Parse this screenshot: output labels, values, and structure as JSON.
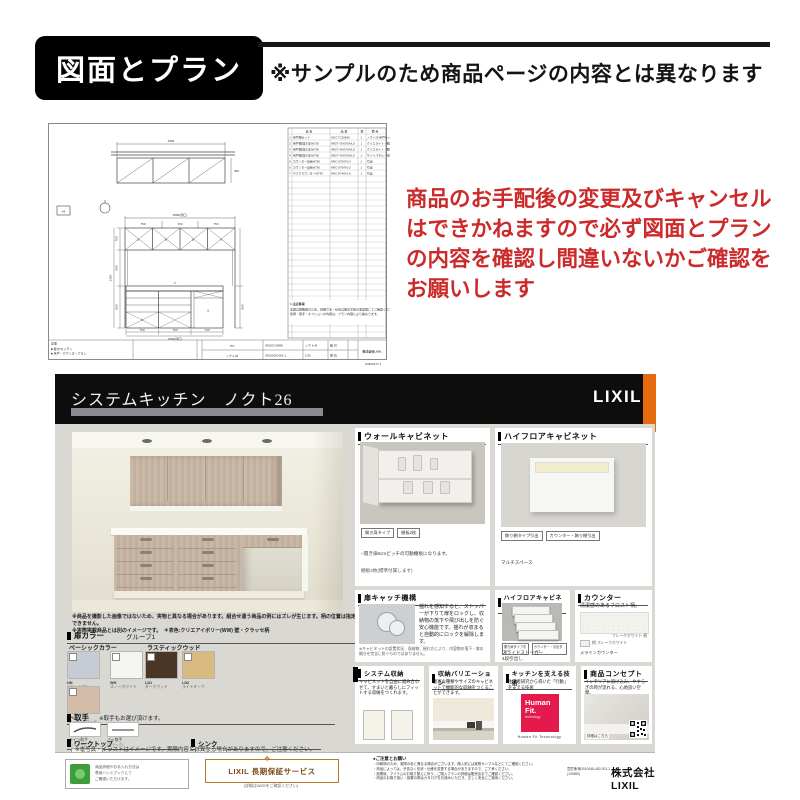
{
  "header": {
    "title": "図面とプラン",
    "note": "※サンプルのため商品ページの内容とは異なります"
  },
  "warning": {
    "text": "商品のお手配後の変更及びキャンセルはできかねますので必ず図面とプランの内容を確認し間違いないかご確認をお願いします",
    "color": "#cc2a2a"
  },
  "drawing": {
    "marker": "A8",
    "plan_total": "2584",
    "plan_height": "350",
    "elev_total": "2584(間口)",
    "elev_parts": [
      "750",
      "700",
      "750"
    ],
    "left_dims": [
      "700",
      "600",
      "850"
    ],
    "left_total": "2350",
    "base_parts": [
      "750",
      "750",
      "740"
    ],
    "base_total": "2584(間口)",
    "refs": {
      "w1": "④",
      "w2": "⑤",
      "w3": "⑥",
      "w4": "⑦",
      "b1": "①",
      "b2": "②",
      "b3": "③"
    },
    "table": {
      "headers": {
        "name": "品  名",
        "code": "品  番",
        "qty": "数",
        "rem": "備  考"
      },
      "rows": [
        [
          "1",
          "吊戸棚セット",
          "NOCT-C2584S",
          "1",
          "ノクト26 吊戸セット(LO)"
        ],
        [
          "2",
          "吊戸棚(開き扉)W750",
          "NR2T-75A075A/LO",
          "1",
          "クリエライト・棚2枚"
        ],
        [
          "3",
          "吊戸棚(開き扉)W700",
          "NR2T-70A070A/LO",
          "1",
          "クリエライト・棚2枚"
        ],
        [
          "4",
          "吊戸棚(開き扉)W750",
          "NR2T-75A075A/LO",
          "1",
          "サイドパネル・化粧"
        ],
        [
          "5",
          "カウンター収納W750",
          "NRC-S75AT/LO",
          "1",
          "引出"
        ],
        [
          "6",
          "カウンター収納W750",
          "NRC-S75AT/LO",
          "1",
          "引出"
        ],
        [
          "7",
          "デスクカウンターW740",
          "NRC-D74AT/LO",
          "1",
          "引出"
        ]
      ],
      "notes_title": "1.注記事項",
      "note1": "本図は概略図のため、詳細寸法・仕様は御注文前の承認図にてご確認ください。",
      "note2": "色柄・取手・オプションの内容は、プラン内容により異なります。"
    },
    "titleblock": {
      "label": "記事",
      "note1": "■ 壁付Iキッチン",
      "note2": "■ 吊戸・カウンタープラン",
      "name": "757",
      "model": "ノクト26",
      "c1a": "4202D 02890",
      "c1b": "4202D3N-001-1",
      "c2a": "ノクト-B",
      "c2b": "1/30",
      "c3a": "縮 尺",
      "c3b": "単 位",
      "company": "株式会社LIXIL",
      "pageno": "A3202477-1"
    }
  },
  "catalog": {
    "title": "システムキッチン　ノクト26",
    "brand": "LIXIL",
    "accent_orange": "#e56a10",
    "disclaimer1": "※商品を撮影した画像ではないため、実物と異なる場合があります。組合せ違う商品の例にはズレが生じます。柄の位置は指定できません。",
    "disclaimer2": "※実際掲載商品とは別のイメージです。　＊表色:クリエアイボリー(WW) 壁・クラッセ柄",
    "door_color": {
      "heading": "扉カラー",
      "group": "グループ1",
      "category_left": "ベーシックカラー",
      "category_right": "ラスティックウッド",
      "swatches": [
        {
          "code": "NN",
          "name": "ソリッドグレー",
          "color": "#c7cbd4"
        },
        {
          "code": "WH",
          "name": "スノーホワイト",
          "color": "#f5f5f2"
        },
        {
          "code": "LD1",
          "name": "ダークウッド",
          "color": "#4b3626"
        },
        {
          "code": "LD2",
          "name": "ライトオーク",
          "color": "#d9ba80"
        },
        {
          "code": "LP1",
          "name": "グレージュウッド",
          "color": "#d3bda9"
        }
      ]
    },
    "handle": {
      "heading": "取手",
      "note": "※取手もお選び頂けます。",
      "items": [
        {
          "label": "ライン取手",
          "sub": "(シルバー)"
        },
        {
          "label": "バー取手",
          "sub": "(ブラック)"
        }
      ]
    },
    "worktop": {
      "heading": "ワークトップ",
      "select": "選択 ▾"
    },
    "sink": {
      "heading": "シンク",
      "select": "選択 ▾"
    },
    "panel_wall": {
      "title": "ウォールキャビネット",
      "chip1": "開き扉タイプ",
      "chip2": "棚板2枚",
      "line1": "○開き扉6cmピッチの可動棚板になります。",
      "line2": "棚板2枚(標準付属します)"
    },
    "panel_high1": {
      "title": "ハイフロアキャビネット",
      "chip1": "飾り棚タイプ引出",
      "chip2": "カウンター・飾り棚引出",
      "caption": "マルチスペース"
    },
    "panel_catch": {
      "title": "扉キャッチ機構",
      "body": "揺れを感知すると、ストッパーが下りて扉をロックし、収納物の落下や飛び出しを防ぐ安心機能です。揺れが収まると自動的にロックを解除します。",
      "foot": "※キャビネットの設置状況、収納物、揺れ方により、内容物の落下・扉の開きを完全に防ぐものではありません。"
    },
    "panel_high2": {
      "title": "ハイフロアキャビネット",
      "chip1": "開き扉タイプ引出",
      "chip2": "カウンター・引出タイプ",
      "caption1": "スライドストッカー",
      "caption2": "4段引出し"
    },
    "panel_counter": {
      "title": "カウンター",
      "body": "清潔感のあるフロスト柄。",
      "label1": "フレークホワイト 柄",
      "label2": "柄:フレークホワイト",
      "label3": "メラミンカウンター"
    },
    "panel_system": {
      "title": "システム収納",
      "body": "キャビネットを自由に組み合わせて、すまいと暮らしにフィットする収納をつくれます。"
    },
    "panel_variation": {
      "title": "収納バリエーション",
      "body": "豊富な種類やサイズのキャビネットで機能的な収納をつくることができます。"
    },
    "panel_tech": {
      "title": "キッチンを支える技術",
      "body": "生活者研究から導いた「行動」を支える技術",
      "logo_top": "Human",
      "logo_mid": "Fit.",
      "logo_sub": "technology",
      "logo_color": "#e31a4b",
      "caption": "Human Fit Technology"
    },
    "panel_concept": {
      "title": "商品コンセプト",
      "body": "インテリアに溶け込み、やすらぎの時が流れる、心地良い空間。",
      "caption": "詳細はこちら"
    },
    "body_note": "※本写真・イラストはイメージです。実際内容とは異なる場合がありますので、ご注意ください。",
    "footer": {
      "cert_line1": "商品詳細やお手入れ方法は",
      "cert_line2": "専用ハンドブックにて",
      "cert_line3": "ご確認いただけます。",
      "warranty_title": "LIXIL 長期保証サービス",
      "warranty_sub": "(詳細はWEBをご確認ください)",
      "notice_heading": "●ご注意とお願い",
      "notice_lines": [
        "・印刷物のため、実際の色と異なる場合がございます。購入前には実物サンプルなどにてご確認ください。",
        "・商品によっては、予告なく形状・仕様を変更する場合がありますので、ご了承ください。",
        "・設置後、アイテムのお取り替えに伴う、ご購入プランの詳細は販売店までご確認ください。",
        "・商品のお取り扱い・設置の際はカタログをお読みいただき、正しく安全にご使用ください。"
      ],
      "rights_line1": "意匠権:第2010048-482-001-1",
      "rights_line2": "(100890)",
      "company": "株式会社 LIXIL"
    }
  },
  "icons": {
    "section_marker": "black-square",
    "warranty_ribbon": "❖",
    "checkbox": "empty-checkbox"
  }
}
